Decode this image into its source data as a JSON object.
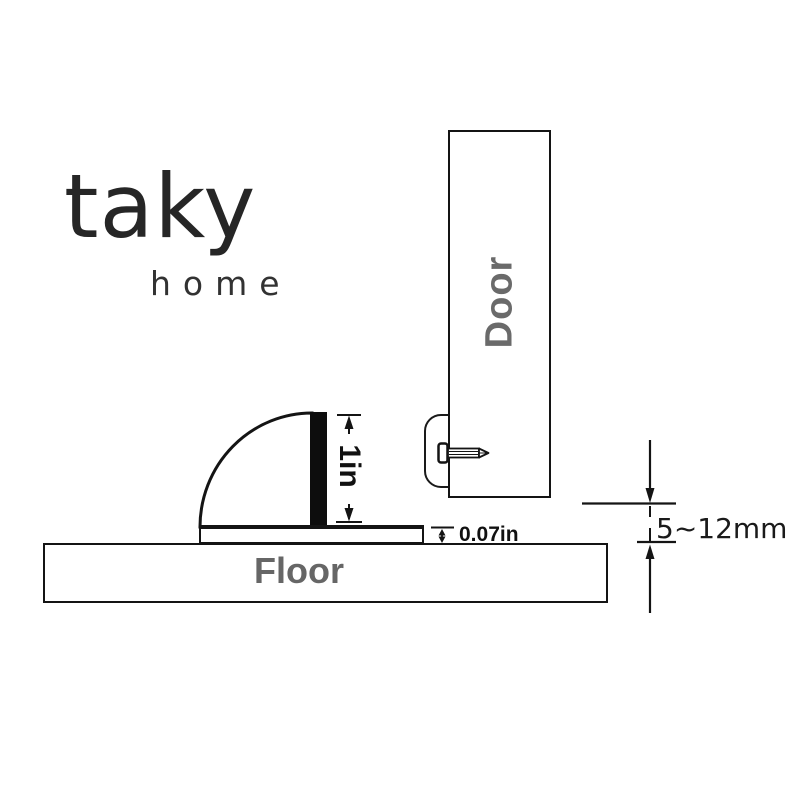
{
  "brand": {
    "name": "taky",
    "tagline": "home"
  },
  "diagram": {
    "door": {
      "label": "Door"
    },
    "floor": {
      "label": "Floor"
    },
    "stopper": {
      "description": "quarter-round door stopper with rubber pad and base plate"
    },
    "dimensions": {
      "stopper_height": "1in",
      "base_thickness": "0.07in",
      "door_floor_gap": "5~12mm"
    }
  },
  "icons": {
    "screw": "screw-icon",
    "mount_tab": "mount-tab",
    "arrows": [
      "dim-arrow-up",
      "dim-arrow-down",
      "dim-double-arrow"
    ]
  },
  "colors": {
    "line": "#141414",
    "label_gray": "#6a6a6a",
    "logo": "#262626",
    "pad_black": "#0d0d0d",
    "background": "#ffffff"
  }
}
